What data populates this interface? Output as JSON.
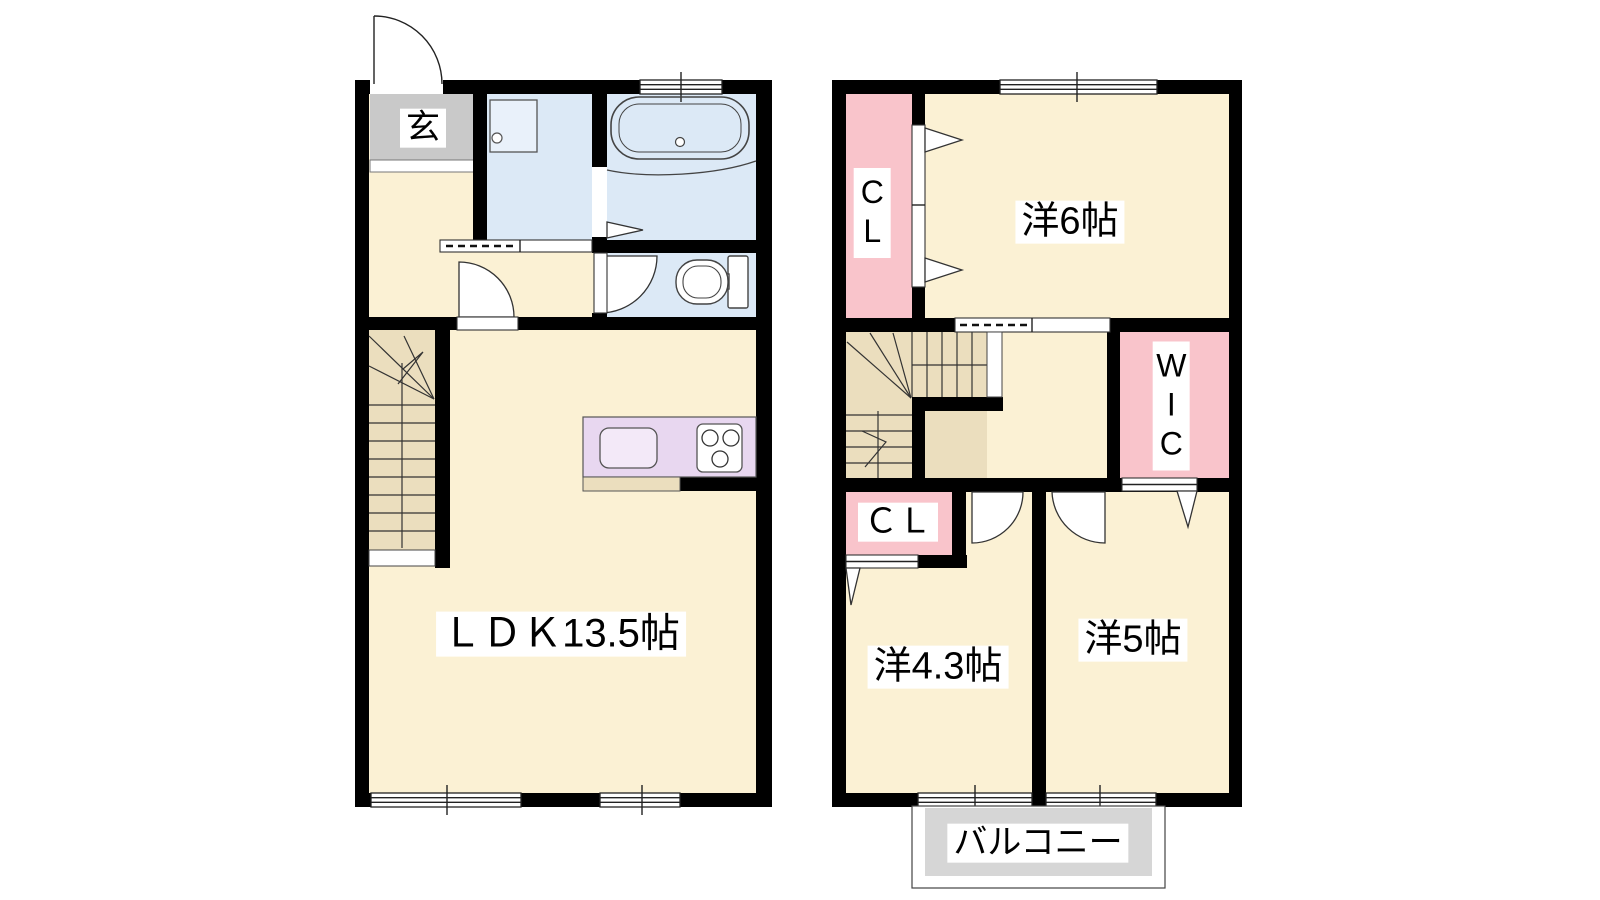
{
  "plan": {
    "floor1": {
      "entrance_label": "玄",
      "ldk_label": "ＬＤＫ13.5帖"
    },
    "floor2": {
      "bedroom6_label": "洋6帖",
      "closet_upper_label": "CL",
      "wic_label": "WIC",
      "closet_lower_label": "ＣＬ",
      "bedroom43_label": "洋4.3帖",
      "bedroom5_label": "洋5帖",
      "balcony_label": "バルコニー"
    },
    "palette": {
      "wall": "#000000",
      "floor": "#FBF1D4",
      "stairs": "#EBDEBE",
      "wet_area": "#DCE9F6",
      "entrance_floor": "#C9C9C9",
      "closet": "#F9C4CB",
      "kitchen_counter": "#E8D7F0",
      "kitchen_sink": "#F3E9F8",
      "washbasin": "#E9F1FA",
      "balcony": "#D6D6D6"
    }
  }
}
